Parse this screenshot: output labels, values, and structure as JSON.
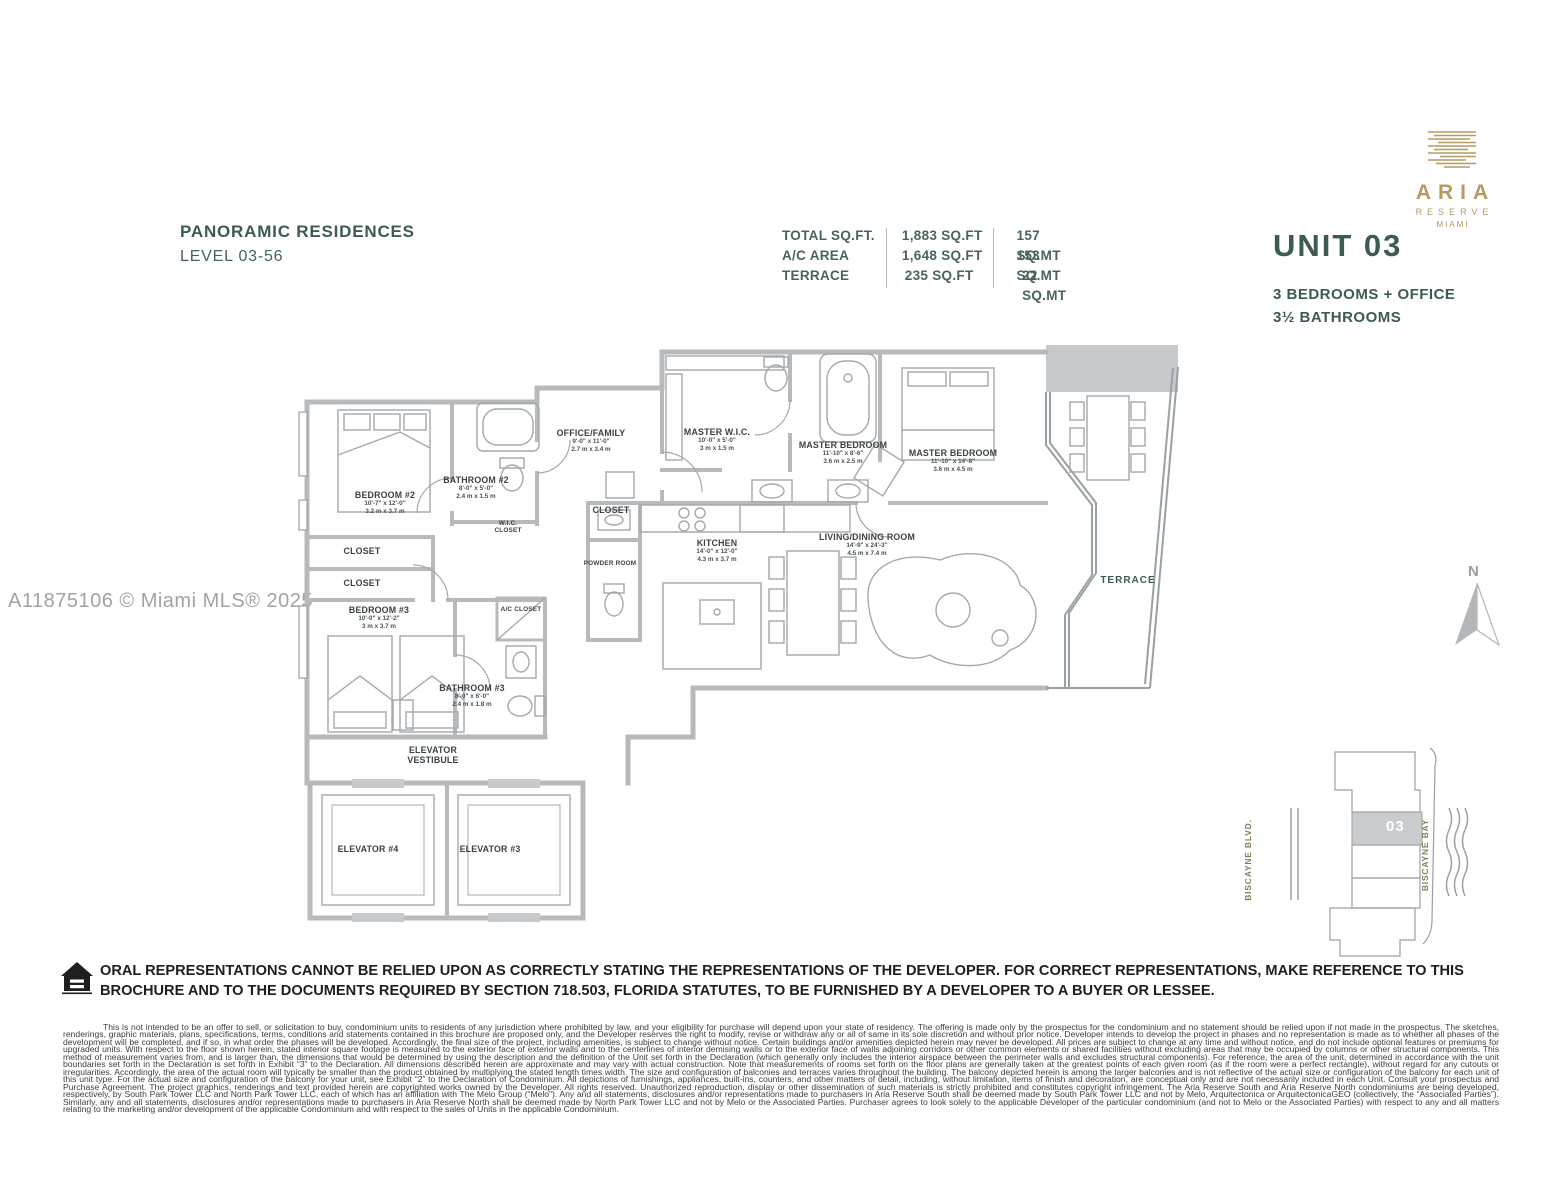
{
  "header": {
    "title": "PANORAMIC RESIDENCES",
    "subtitle": "LEVEL 03-56"
  },
  "area_table": {
    "rows": [
      {
        "label": "TOTAL SQ.FT.",
        "sqft": "1,883 SQ.FT",
        "sqmt": "157 SQ.MT"
      },
      {
        "label": "A/C AREA",
        "sqft": "1,648 SQ.FT",
        "sqmt": "153 SQ.MT"
      },
      {
        "label": "TERRACE",
        "sqft": "235 SQ.FT",
        "sqmt": "22 SQ.MT"
      }
    ]
  },
  "brand": {
    "name": "ARIA",
    "line2": "RESERVE",
    "line3": "MIAMI",
    "gold": "#b59a62"
  },
  "unit": {
    "number": "UNIT 03",
    "feature1": "3 BEDROOMS + OFFICE",
    "feature2": "3½ BATHROOMS"
  },
  "watermark": "A11875106 © Miami MLS® 2025",
  "compass": {
    "label": "N"
  },
  "floorplan": {
    "accent_green": "#3d5b50",
    "wall_gray": "#b6babc",
    "rooms": [
      {
        "name": "BEDROOM #2",
        "ft": "10'-7\" x 12'-0\"",
        "m": "3.2 m x 3.7 m"
      },
      {
        "name": "BATHROOM #2",
        "ft": "8'-0\" x 5'-0\"",
        "m": "2.4 m x 1.5 m"
      },
      {
        "name": "OFFICE/FAMILY",
        "ft": "9'-0\" x 11'-0\"",
        "m": "2.7 m x 3.4 m"
      },
      {
        "name": "MASTER W.I.C.",
        "ft": "10'-0\" x 5'-0\"",
        "m": "3 m x 1.5 m"
      },
      {
        "name": "MASTER BEDROOM",
        "ft": "11'-10\" x 8'-6\"",
        "m": "3.6 m x 2.5 m"
      },
      {
        "name": "MASTER BEDROOM",
        "ft": "11'-10\" x 14'-8\"",
        "m": "3.6 m x 4.5 m"
      },
      {
        "name": "KITCHEN",
        "ft": "14'-0\" x 12'-0\"",
        "m": "4.3 m x 3.7 m"
      },
      {
        "name": "LIVING/DINING ROOM",
        "ft": "14'-9\" x 24'-3\"",
        "m": "4.5 m x 7.4 m"
      },
      {
        "name": "BEDROOM #3",
        "ft": "10'-0\" x 12'-2\"",
        "m": "3 m x 3.7 m"
      },
      {
        "name": "BATHROOM #3",
        "ft": "8'-0\" x 6'-0\"",
        "m": "2.4 m x 1.8 m"
      },
      {
        "name": "CLOSET"
      },
      {
        "name": "CLOSET"
      },
      {
        "name": "W.I.C. CLOSET"
      },
      {
        "name": "CLOSET"
      },
      {
        "name": "POWDER ROOM"
      },
      {
        "name": "A/C CLOSET"
      },
      {
        "name": "TERRACE"
      },
      {
        "name": "ELEVATOR VESTIBULE"
      },
      {
        "name": "ELEVATOR #4"
      },
      {
        "name": "ELEVATOR #3"
      }
    ]
  },
  "keyplan": {
    "unit_number": "03",
    "street": "BISCAYNE BLVD.",
    "bay": "BISCAYNE BAY"
  },
  "legal": {
    "bold_notice": "ORAL REPRESENTATIONS CANNOT BE RELIED UPON AS CORRECTLY STATING THE REPRESENTATIONS OF THE DEVELOPER. FOR CORRECT REPRESENTATIONS, MAKE REFERENCE TO THIS BROCHURE AND TO THE DOCUMENTS REQUIRED BY SECTION 718.503, FLORIDA STATUTES, TO BE FURNISHED BY A DEVELOPER TO A BUYER OR LESSEE.",
    "fine_print": "This is not intended to be an offer to sell, or solicitation to buy, condominium units to residents of any jurisdiction where prohibited by law, and your eligibility for purchase will depend upon your state of residency. The offering is made only by the prospectus for the condominium and no statement should be relied upon if not made in the prospectus. The sketches, renderings, graphic materials, plans, specifications, terms, conditions and statements contained in this brochure are proposed only, and the Developer reserves the right to modify, revise or withdraw any or all of same in its sole discretion and without prior notice. Developer intends to develop the project in phases and no representation is made as to whether all phases of the development will be completed, and if so, in what order the phases will be developed. Accordingly, the final size of the project, including amenities, is subject to change without notice. Certain buildings and/or amenities depicted herein may never be developed. All prices are subject to change at any time and without notice, and do not include optional features or premiums for upgraded units. With respect to the floor shown herein, stated interior square footage is measured to the exterior face of exterior walls and to the centerlines of interior demising walls or to the exterior face of walls adjoining corridors or other common elements or shared facilities without excluding areas that may be occupied by columns or other structural components. This method of measurement varies from, and is larger than, the dimensions that would be determined by using the description and the definition of the Unit set forth in the Declaration (which generally only includes the interior airspace between the perimeter walls and excludes structural components). For reference, the area of the unit, determined in accordance with the unit boundaries set forth in the Declaration is set forth in Exhibit “3” to the Declaration. All dimensions described herein are approximate and may vary with actual construction. Note that measurements of rooms set forth on the floor plans are generally taken at the greatest points of each given room (as if the room were a perfect rectangle), without regard for any cutouts or irregularities. Accordingly, the area of the actual room will typically be smaller than the product obtained by multiplying the stated length times width. The size and configuration of balconies and terraces varies throughout the building. The balcony depicted herein is among the larger balconies and is not reflective of the actual size or configuration of the balcony for each unit of this unit type. For the actual size and configuration of the balcony for your unit, see Exhibit “2” to the Declaration of Condominium. All depictions of furnishings, appliances, built-ins, counters, and other matters of detail, including, without limitation, items of finish and decoration, are conceptual only and are not necessarily included in each Unit. Consult your prospectus and Purchase Agreement. The project graphics, renderings and text provided herein are copyrighted works owned by the Developer. All rights reserved. Unauthorized reproduction, display or other dissemination of such materials is strictly prohibited and constitutes copyright infringement. The Aria Reserve South and Aria Reserve North condominiums are being developed, respectively, by South Park Tower LLC and North Park Tower LLC, each of which has an affiliation with The Melo Group (“Melo”). Any and all statements, disclosures and/or representations made to purchasers in Aria Reserve South shall be deemed made by South Park Tower LLC and not by Melo, Arquitectonica or ArquitectonicaGEO (collectively, the “Associated Parties”). Similarly, any and all statements, disclosures and/or representations made to purchasers in Aria Reserve North shall be deemed made by North Park Tower LLC and not by Melo or the Associated Parties. Purchaser agrees to look solely to the applicable Developer of the particular condominium (and not to Melo or the Associated Parties) with respect to any and all matters relating to the marketing and/or development of the applicable Condominium and with respect to the sales of Units in the applicable Condominium."
  }
}
